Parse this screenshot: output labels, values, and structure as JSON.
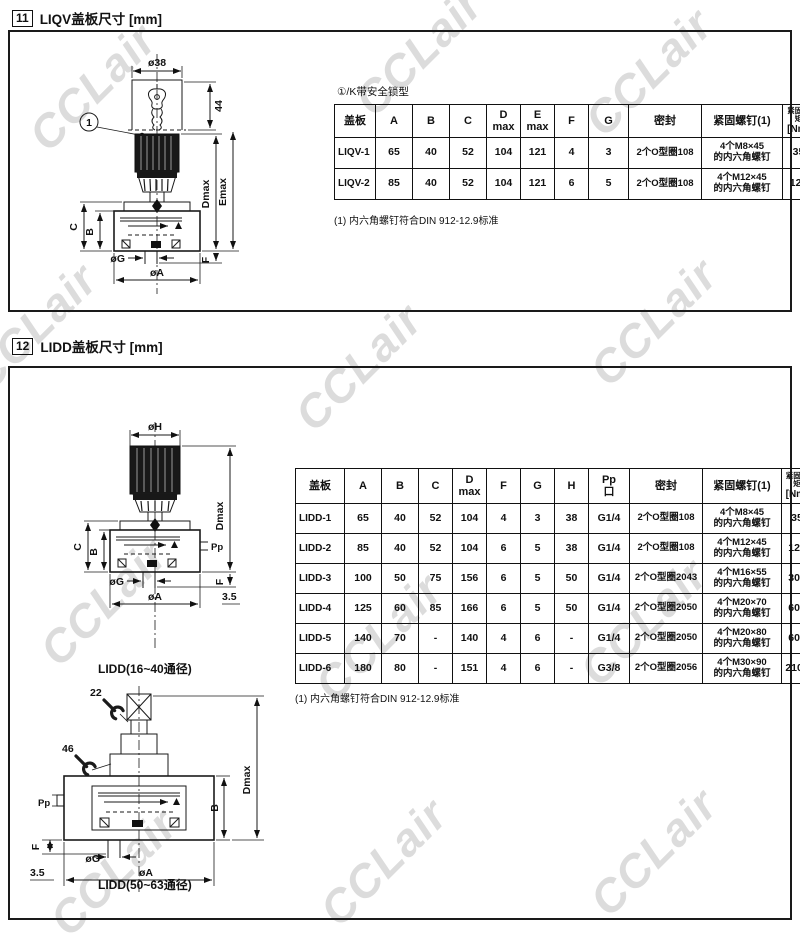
{
  "watermark": {
    "text": "CCLair"
  },
  "section11": {
    "number": "11",
    "title": "LIQV盖板尺寸  [mm]",
    "note": "①/K带安全锁型",
    "footnote": "(1) 内六角螺钉符合DIN 912-12.9标准",
    "drawing": {
      "dia_top": "ø38",
      "dim_44": "44",
      "item_no": "1",
      "dim_c": "C",
      "dim_b": "B",
      "dim_dmax": "Dmax",
      "dim_emax": "Emax",
      "dia_g": "øG",
      "dia_a": "øA",
      "dim_f": "F"
    },
    "table": {
      "headers": [
        "盖板",
        "A",
        "B",
        "C",
        "D\nmax",
        "E\nmax",
        "F",
        "G",
        "密封",
        "紧固螺钉(1)",
        "紧固力矩\n[Nm]",
        "重量\n[kg]"
      ],
      "rows": [
        [
          "LIQV-1",
          "65",
          "40",
          "52",
          "104",
          "121",
          "4",
          "3",
          "2个O型圈108",
          "4个M8×45\n的内六角螺钉",
          "35",
          "1.7"
        ],
        [
          "LIQV-2",
          "85",
          "40",
          "52",
          "104",
          "121",
          "6",
          "5",
          "2个O型圈108",
          "4个M12×45\n的内六角螺钉",
          "125",
          "2.1"
        ]
      ]
    }
  },
  "section12": {
    "number": "12",
    "title": "LIDD盖板尺寸  [mm]",
    "footnote": "(1) 内六角螺钉符合DIN 912-12.9标准",
    "drawing1": {
      "dia_top": "øH",
      "dim_c": "C",
      "dim_b": "B",
      "dim_dmax": "Dmax",
      "dim_pp": "Pp",
      "dia_g": "øG",
      "dia_a": "øA",
      "dim_f": "F",
      "dim_offset": "3.5",
      "caption": "LIDD(16~40通径)"
    },
    "drawing2": {
      "wrench_22": "22",
      "wrench_46": "46",
      "dim_dmax": "Dmax",
      "dim_b": "B",
      "dim_pp": "Pp",
      "dim_f": "F",
      "dim_offset": "3.5",
      "dia_g": "øG",
      "dia_a": "øA",
      "caption": "LIDD(50~63通径)"
    },
    "table": {
      "headers": [
        "盖板",
        "A",
        "B",
        "C",
        "D\nmax",
        "F",
        "G",
        "H",
        "Pp\n口",
        "密封",
        "紧固螺钉(1)",
        "紧固力矩\n[Nm]",
        "重量\n[kg]"
      ],
      "rows": [
        [
          "LIDD-1",
          "65",
          "40",
          "52",
          "104",
          "4",
          "3",
          "38",
          "G1/4",
          "2个O型圈108",
          "4个M8×45\n的内六角螺钉",
          "35",
          "2"
        ],
        [
          "LIDD-2",
          "85",
          "40",
          "52",
          "104",
          "6",
          "5",
          "38",
          "G1/4",
          "2个O型圈108",
          "4个M12×45\n的内六角螺钉",
          "125",
          "2.4"
        ],
        [
          "LIDD-3",
          "100",
          "50",
          "75",
          "156",
          "6",
          "5",
          "50",
          "G1/4",
          "2个O型圈2043",
          "4个M16×55\n的内六角螺钉",
          "300",
          "2.8"
        ],
        [
          "LIDD-4",
          "125",
          "60",
          "85",
          "166",
          "6",
          "5",
          "50",
          "G1/4",
          "2个O型圈2050",
          "4个M20×70\n的内六角螺钉",
          "600",
          "6.7"
        ],
        [
          "LIDD-5",
          "140",
          "70",
          "-",
          "140",
          "4",
          "6",
          "-",
          "G1/4",
          "2个O型圈2050",
          "4个M20×80\n的内六角螺钉",
          "600",
          "9.8"
        ],
        [
          "LIDD-6",
          "180",
          "80",
          "-",
          "151",
          "4",
          "6",
          "-",
          "G3/8",
          "2个O型圈2056",
          "4个M30×90\n的内六角螺钉",
          "2100",
          "17.5"
        ]
      ]
    }
  }
}
